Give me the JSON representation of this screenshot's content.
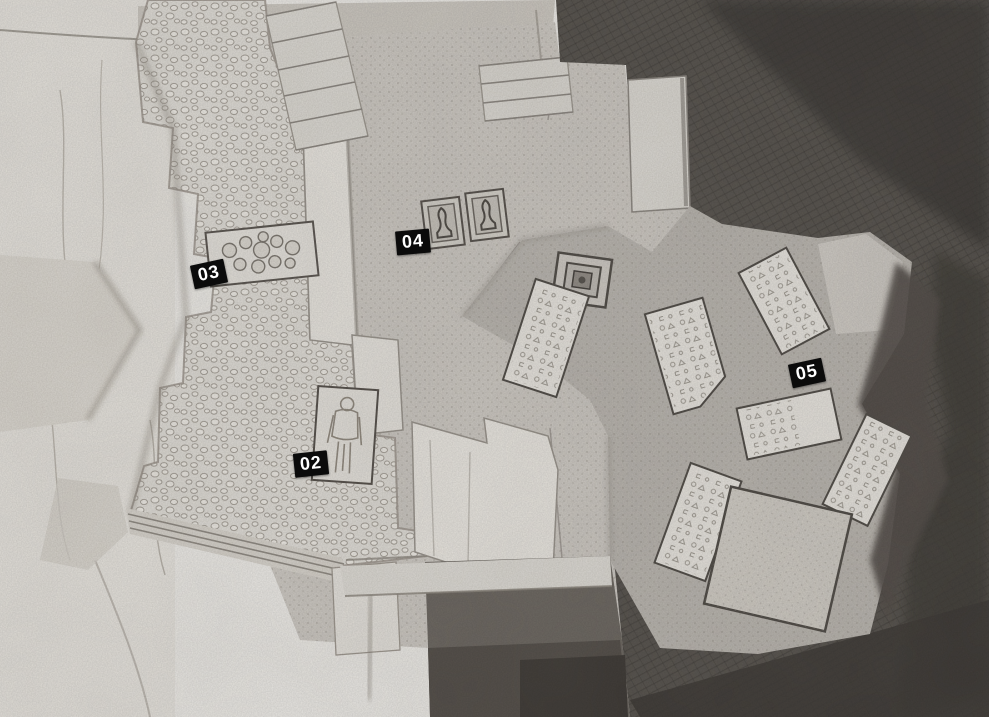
{
  "map": {
    "title": "hand-drawn tomb level map",
    "style": "pencil sketch, top-down dungeon plan",
    "badge": {
      "bg": "#0b0b0b",
      "text_color": "#ffffff"
    },
    "palette": {
      "paper": "#e7e5e1",
      "light_rock": "#e0ddd6",
      "platform_gray": "#c8c4be",
      "chamber_gray": "#b6b2ac",
      "dark_rock": "#57534e",
      "pit": "#524d48"
    },
    "markers": [
      {
        "id": "02",
        "x": 294,
        "y": 452,
        "rot": -6,
        "feature": "sarcophagus-with-human-figure"
      },
      {
        "id": "03",
        "x": 192,
        "y": 262,
        "rot": -12,
        "feature": "rubble-pile-recess"
      },
      {
        "id": "04",
        "x": 396,
        "y": 230,
        "rot": -5,
        "feature": "twin-statue-alcoves"
      },
      {
        "id": "05",
        "x": 790,
        "y": 361,
        "rot": -12,
        "feature": "chamber-of-inscribed-slabs"
      }
    ],
    "features": [
      "staircase-top-left",
      "staircase-top-center",
      "pebble-floor-hall",
      "raised-stone-walkway",
      "sarcophagus",
      "rubble-pile",
      "statue-alcoves",
      "square-pedestal",
      "inscribed-slabs",
      "large-stone-block",
      "dark-pit",
      "narrow-passage"
    ]
  }
}
